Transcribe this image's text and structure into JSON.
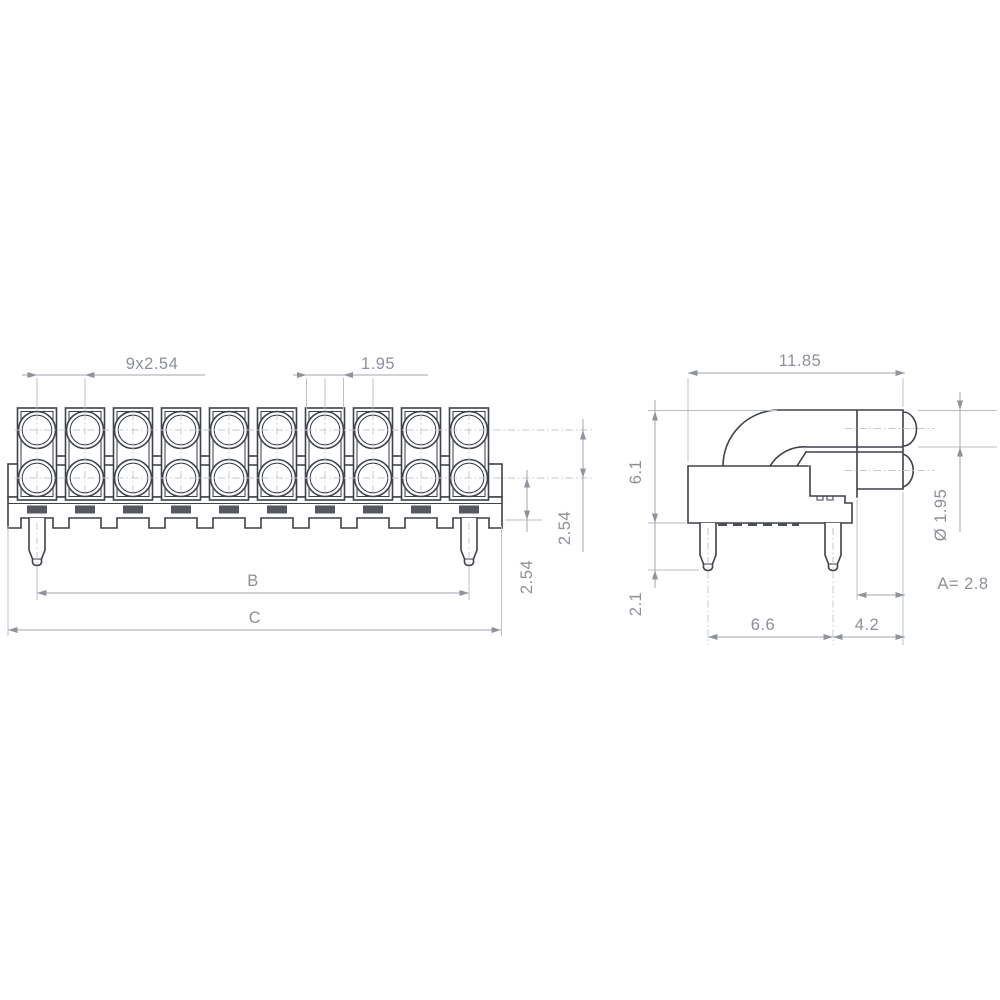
{
  "drawing": {
    "colors": {
      "background": "#ffffff",
      "outline": "#3d4148",
      "dimension_line": "#a2a6ae",
      "dimension_text": "#8b9099",
      "centerline": "#c3c6cc",
      "lead_pad": "#55585f"
    },
    "front_view": {
      "led_columns": 10,
      "led_rows": 2,
      "mounting_pins": 2,
      "dims": {
        "pitch": "9x2.54",
        "led_diameter": "1.95",
        "row_pitch": "2.54",
        "row_to_seating": "2.54",
        "pin_span": "B",
        "overall_width": "C"
      }
    },
    "side_view": {
      "mounting_pins": 2,
      "dims": {
        "overall_depth": "11.85",
        "body_height": "6.1",
        "pin_protrusion": "2.1",
        "pin_spacing": "6.6",
        "lens_offset": "4.2",
        "lens_diameter": "Ø 1.95",
        "dim_a": "A= 2.8"
      }
    }
  }
}
